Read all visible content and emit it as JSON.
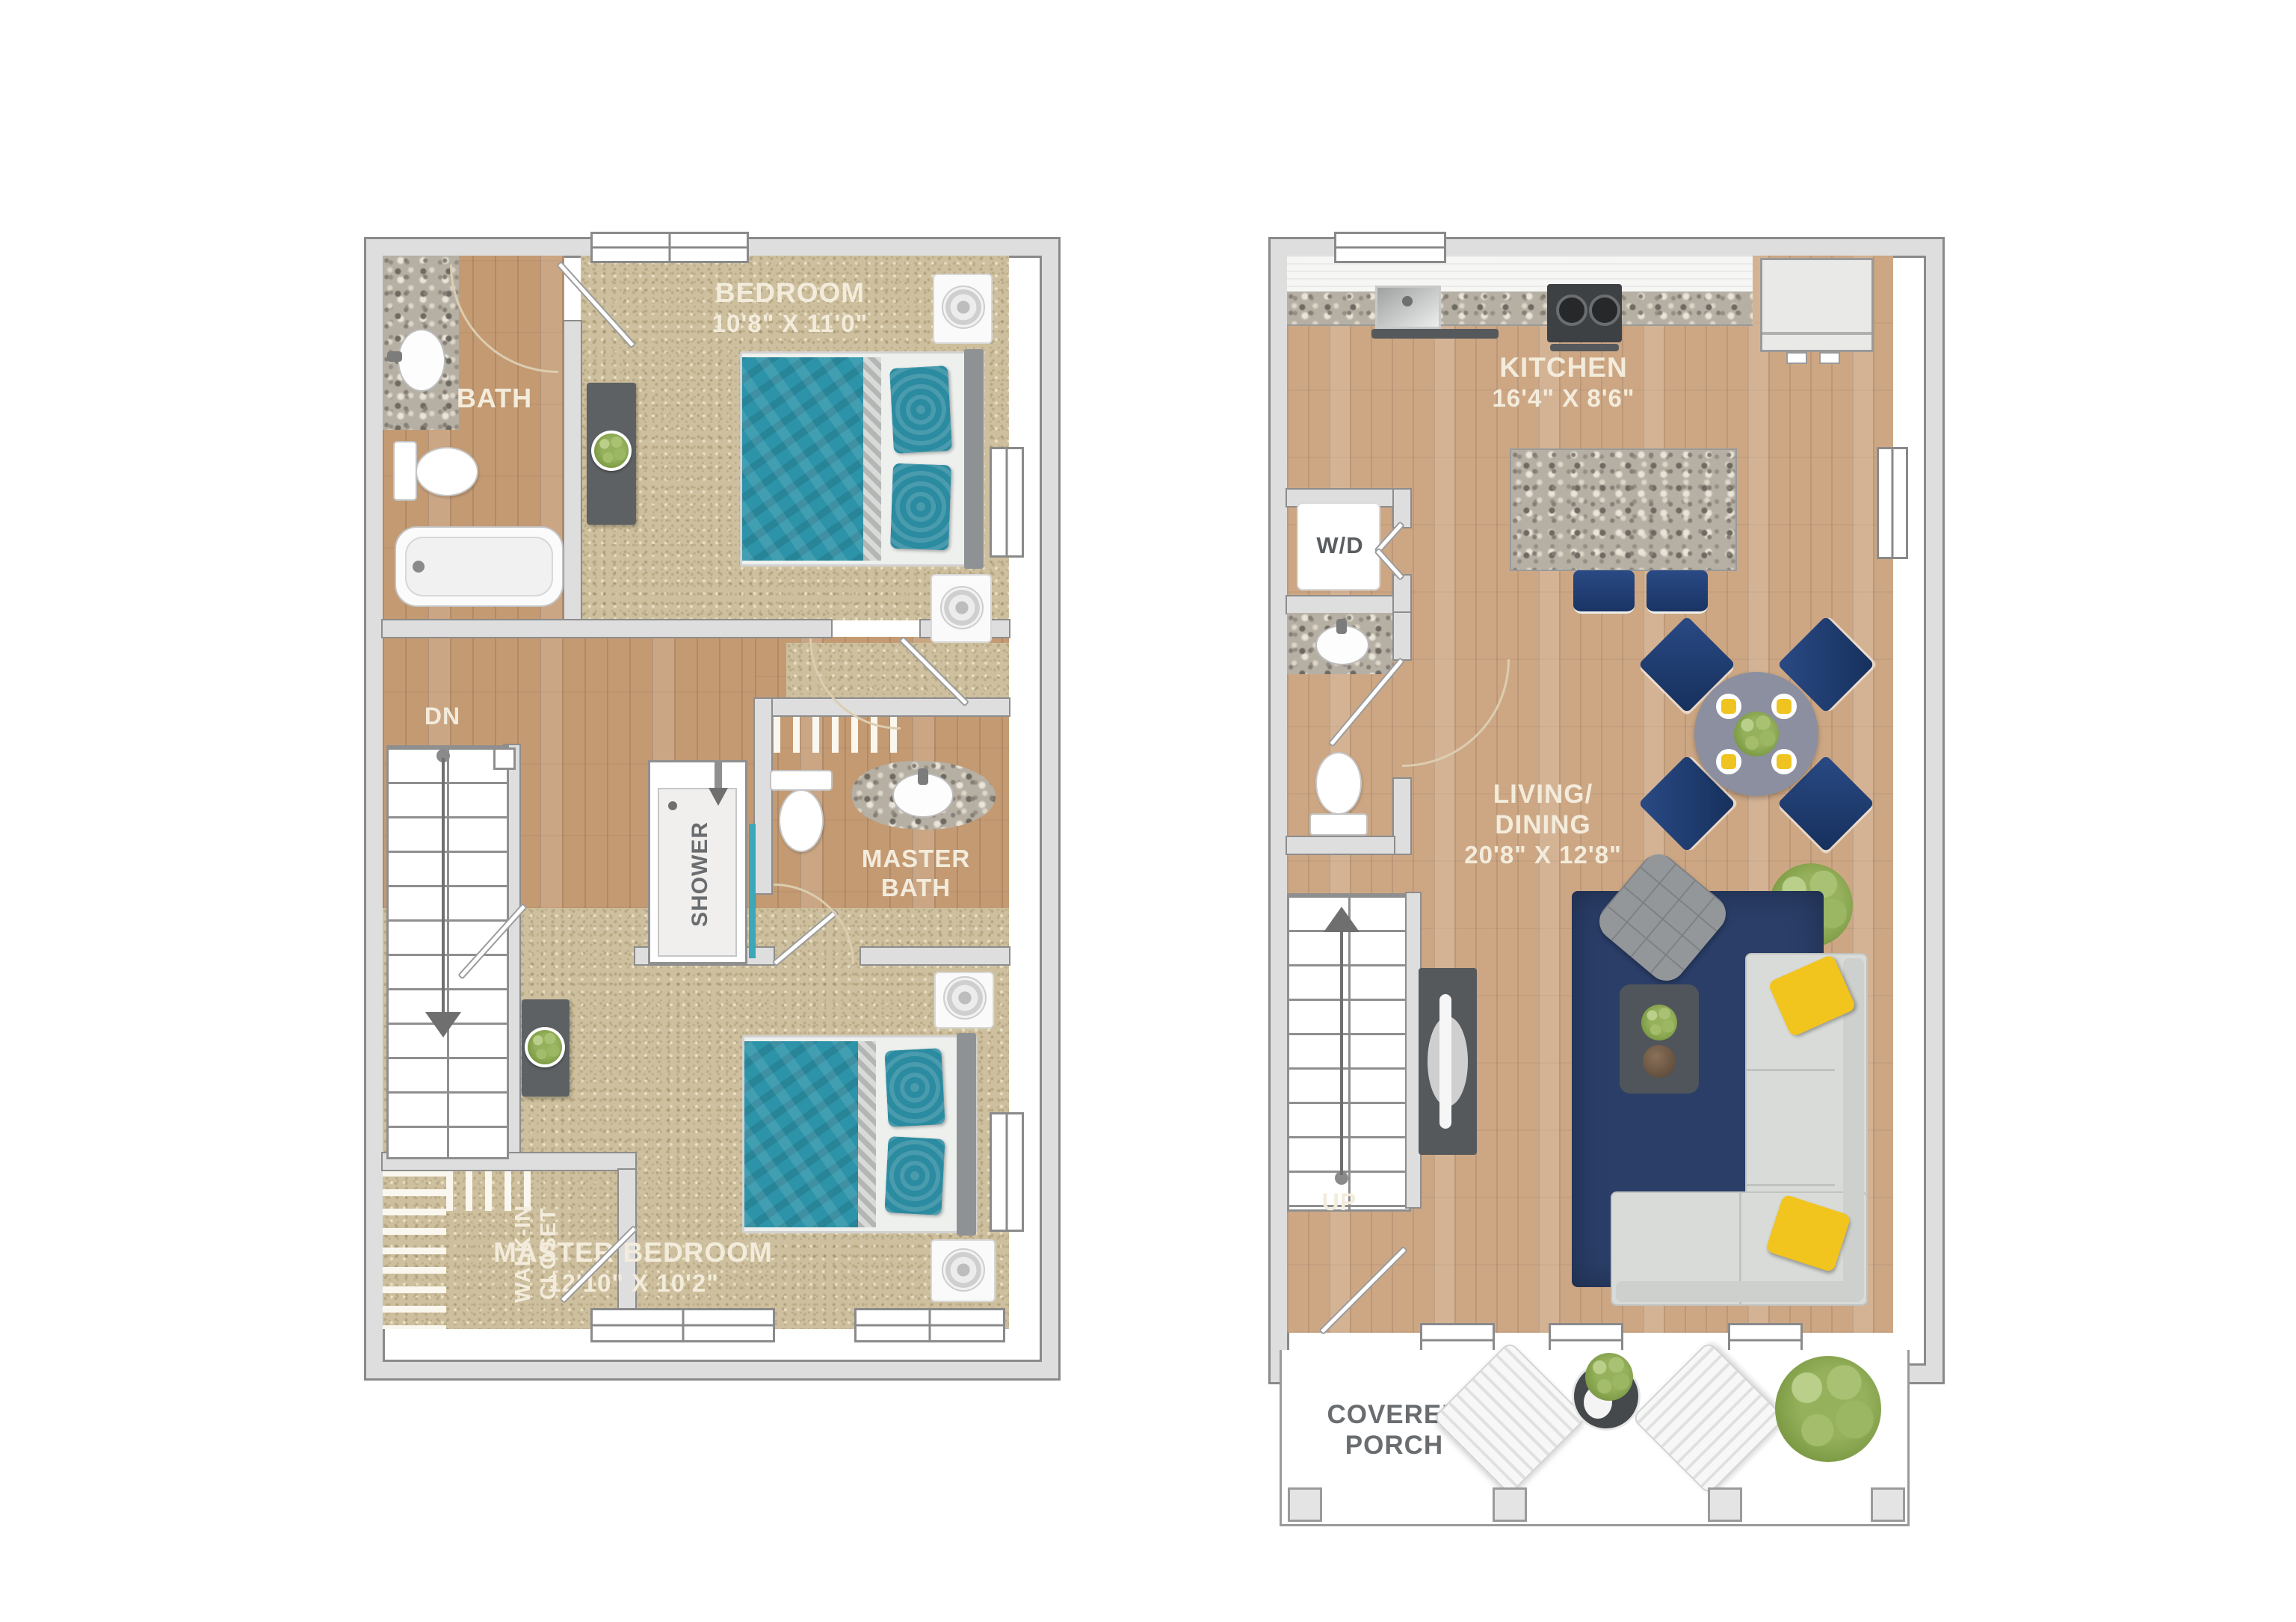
{
  "upper_floor": {
    "bath": {
      "label": "BATH"
    },
    "bedroom": {
      "label": "BEDROOM",
      "dimensions": "10'8\" X 11'0\""
    },
    "stairs": {
      "label": "DN"
    },
    "shower": {
      "label": "SHOWER"
    },
    "master_bath": {
      "label": "MASTER BATH"
    },
    "walk_in_closet": {
      "label": "WALK-IN CLOSET"
    },
    "master_bedroom": {
      "label": "MASTER BEDROOM",
      "dimensions": "12'10\" X 10'2\""
    }
  },
  "main_floor": {
    "kitchen": {
      "label": "KITCHEN",
      "dimensions": "16'4\" X 8'6\""
    },
    "laundry": {
      "label": "W/D"
    },
    "living_dining": {
      "label_line1": "LIVING/",
      "label_line2": "DINING",
      "dimensions": "20'8\" X 12'8\""
    },
    "stairs": {
      "label": "UP"
    },
    "covered_porch": {
      "label": "COVERED PORCH"
    }
  },
  "palette": {
    "wall": "#dedede",
    "wall_line": "#8d8d8d",
    "carpet": "#cec09e",
    "wood": "#c49a73",
    "wood_light": "#cda784",
    "teal_bed": "#2d93a8",
    "navy": "#1f3c6e",
    "rug_navy": "#2a3e68",
    "yellow_pillow": "#f2c41e",
    "sofa_gray": "#d8dbd7",
    "label_cream": "#f3ecdc",
    "label_gray": "#6a6d70",
    "plant_green": "#93b45e"
  }
}
